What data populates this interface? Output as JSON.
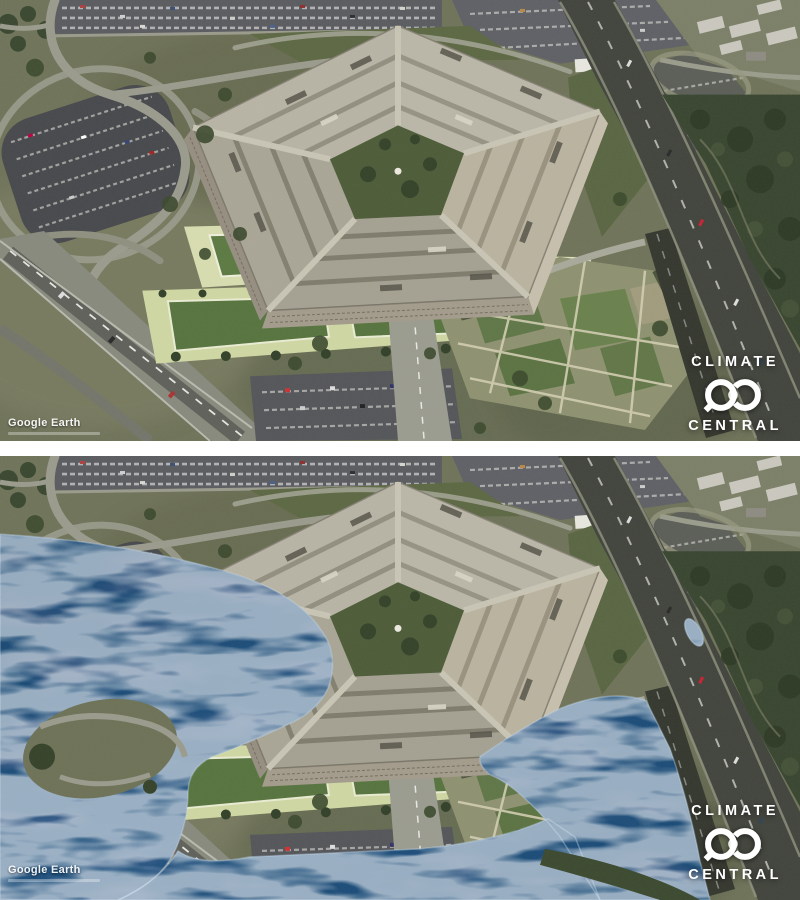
{
  "logo": {
    "line1": "CLIMATE",
    "line2": "CENTRAL"
  },
  "attribution": {
    "text": "Google Earth"
  },
  "icons": {
    "logo_mark": "climate-central-interlocking-c-rings"
  },
  "colors": {
    "divider": "#ffffff",
    "terrain": "#70745a",
    "forest": "#394630",
    "pentagon_roof": "#b3af9f",
    "courtyard": "#4e5c39",
    "terrace_pale": "#d8ddb0",
    "lawn": "#5d7a43",
    "asphalt": "#42453d",
    "water": "#2e5078",
    "water_deep": "#22406a",
    "logo_white": "#ffffff"
  }
}
